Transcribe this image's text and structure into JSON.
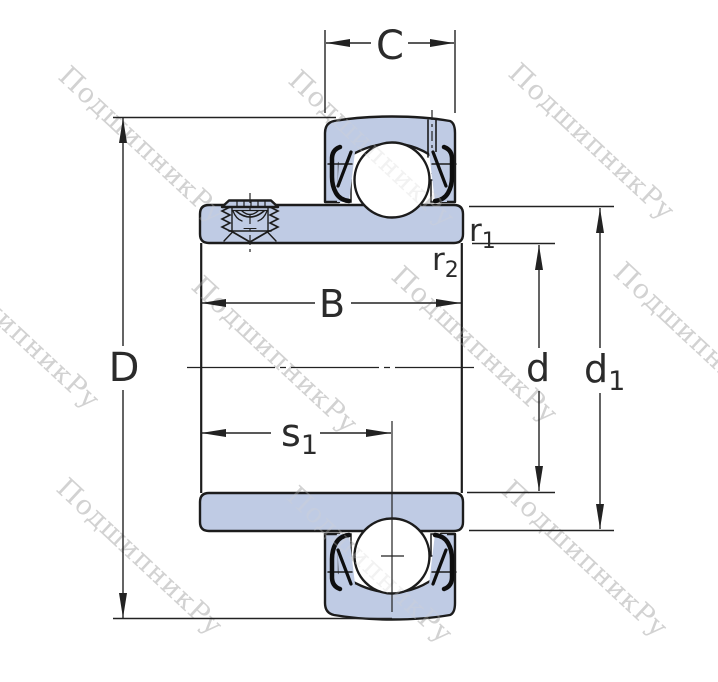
{
  "title": "Insert ball bearing cross-section drawing with dimension symbols",
  "watermark": {
    "text": "ПодшипникРу"
  },
  "colors": {
    "background": "#ffffff",
    "part_fill": "#bfcbe4",
    "outline": "#1c1c1c",
    "seal": "#0e0e0e",
    "dim_line": "#222222",
    "label_text": "#2b2b2b",
    "watermark": "#d2d2d2"
  },
  "labels": {
    "C": "C",
    "D": "D",
    "B": "B",
    "s1": {
      "base": "s",
      "sub": "1"
    },
    "r1": {
      "base": "r",
      "sub": "1"
    },
    "r2": {
      "base": "r",
      "sub": "2"
    },
    "d": "d",
    "d1": {
      "base": "d",
      "sub": "1"
    }
  }
}
